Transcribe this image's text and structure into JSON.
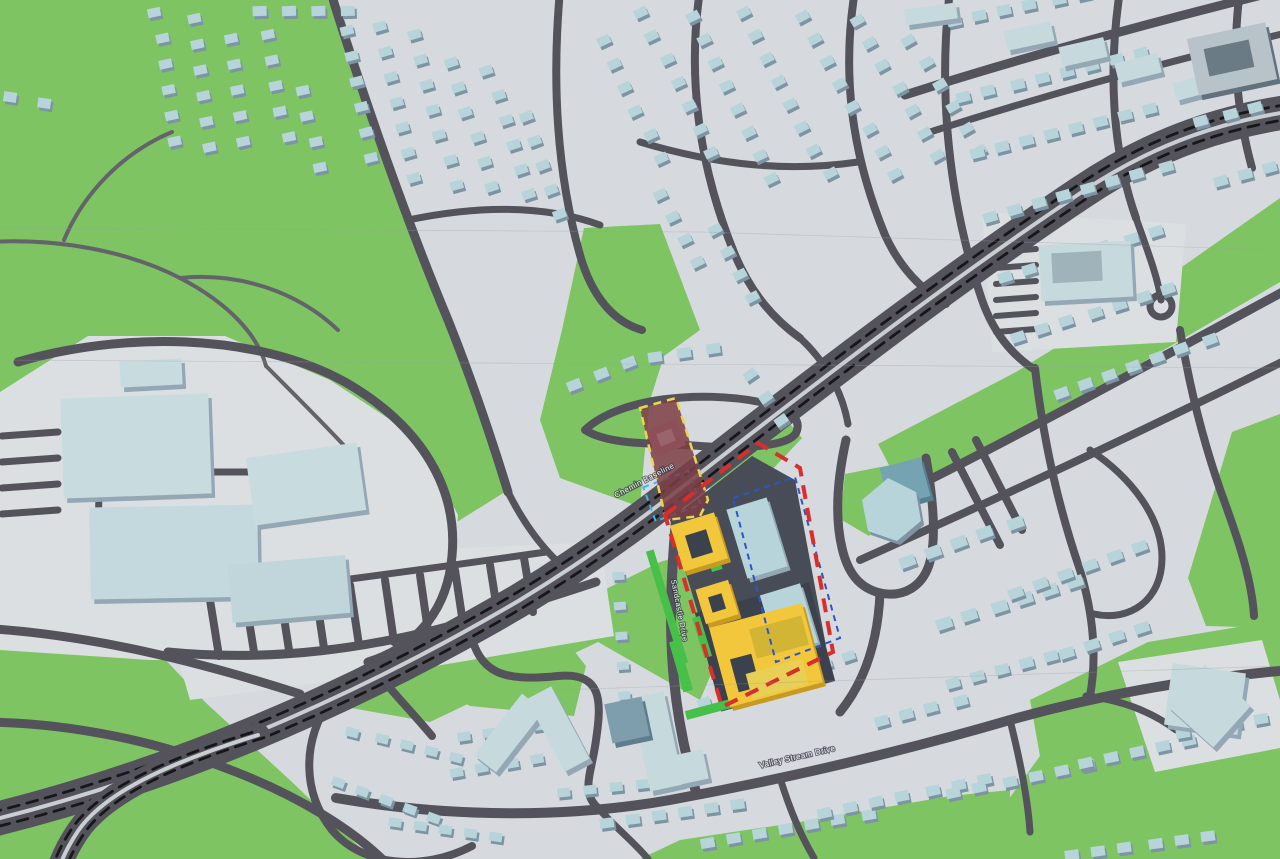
{
  "map": {
    "street_labels": [
      {
        "text": "Chemin Baseline"
      },
      {
        "text": "Sandcastle Drive"
      },
      {
        "text": "Valley Stream Drive"
      }
    ],
    "palette": {
      "pavement": "#d6dade",
      "pad": "#dbdfe2",
      "green": "#7ec462",
      "green_bright": "#46c049",
      "road": "#54535c",
      "trail": "#64636b",
      "median": "#c9ced3",
      "dash_black": "#17171a",
      "house": "#b6d4d9",
      "house_shadow": "#7d94a2",
      "big_building": "#c6d9dc",
      "big_side": "#93a8b4",
      "teal_tower": "#76a3b2",
      "site_asphalt": "#474c56",
      "site_podium": "#3c414e",
      "yellow_building": "#f3c73c",
      "yellow_side": "#c79a22",
      "yellow_roof_dark": "#3c414e",
      "yellow_roof_olive": "#d2b535",
      "yellow_roof_stripe": "#e8cf55",
      "maroon_overlay": "#7d3e45",
      "maroon_building": "#8d5059",
      "maroon_inner": "#9a646c",
      "boundary_red": "#d92e2c",
      "boundary_yellow": "#ead54e",
      "boundary_navy": "#2d55c8",
      "boundary_cyan": "#45b5e8",
      "seam": "#9aa0a6"
    },
    "greens": [
      "M0,0 L328,0 L400,185 L455,330 L505,492 L436,535 L300,482 L150,470 L0,464 Z",
      "M584,228 L660,224 L700,330 L664,356 L650,400 L644,460 L640,507 L560,478 L540,420 L562,330 Z",
      "M704,466 L790,424 L802,438 L770,472 L712,498 Z",
      "M845,474 L896,464 L906,500 L869,536 L840,519 Z",
      "M878,444 L1016,372 L1152,288 L1280,198 L1280,282 L1150,358 L1018,438 L904,494 Z",
      "M1030,700 L1148,642 L1280,620 L1280,859 L1005,859 L1008,800 L1040,756 Z",
      "M1232,432 L1280,414 L1280,628 L1206,626 L1188,578 Z",
      "M340,706 L520,632 L660,562 L712,546 L736,616 L700,700 L598,642 L430,722 Z",
      "M424,640 L556,628 L586,666 L574,716 L470,706 L428,682 Z",
      "M0,645 L162,656 L205,702 L292,782 L372,859 L0,859 Z",
      "M640,859 L680,840 L800,822 L950,796 L1010,790 L1010,859 Z"
    ],
    "pads": [
      "M0,392 L88,336 L225,336 L330,380 L418,438 L458,515 L452,585 L420,642 L330,660 L150,660 L0,650 Z",
      "M150,562 L600,542 L614,636 L400,672 L190,700 Z",
      "M982,212 L1186,224 L1176,342 L992,352 Z",
      "M1118,662 L1262,640 L1280,700 L1280,748 L1155,772 Z"
    ],
    "trails": [
      [
        "M-10,242 C60,238 130,252 180,278 C230,304 258,336 266,366",
        4
      ],
      [
        "M64,240 C84,192 124,152 172,132",
        4
      ],
      [
        "M180,278 C240,272 298,292 338,330",
        4
      ],
      [
        "M266,366 C300,400 330,430 350,452",
        4
      ]
    ],
    "roads": [
      [
        "M330,-10 C358,80 402,210 448,320 C470,375 492,440 508,492",
        9
      ],
      [
        "M560,-10 C552,80 556,170 580,255 C592,297 614,322 642,330",
        8
      ],
      [
        "M408,220 C480,205 545,205 600,225",
        7
      ],
      [
        "M700,-10 C688,70 696,160 735,255 C752,295 775,320 800,338",
        8
      ],
      [
        "M855,-10 C842,70 850,150 885,235 C900,268 922,290 946,304",
        8
      ],
      [
        "M640,142 C720,166 790,172 858,162",
        7
      ],
      [
        "M585,430 C618,398 700,390 760,402 C792,409 802,420 796,433 C788,447 740,449 700,446 C660,443 610,446 585,430",
        8
      ],
      [
        "M800,338 C824,360 842,390 848,424",
        7
      ],
      [
        "M905,95 C1030,55 1160,20 1290,-12",
        9
      ],
      [
        "M930,132 C1040,97 1150,66 1290,32",
        7
      ],
      [
        "M950,-10 C938,90 948,200 982,300 C994,334 1012,354 1032,368",
        8
      ],
      [
        "M1120,-10 C1108,70 1112,150 1136,218",
        8
      ],
      [
        "M1240,-10 C1232,50 1236,110 1252,168",
        8
      ],
      [
        "M1136,218 C1148,252 1158,278 1161,300",
        7
      ],
      [
        "M905,492 C1010,440 1120,380 1290,288",
        9
      ],
      [
        "M860,560 C980,506 1100,452 1290,358",
        8
      ],
      [
        "M1035,368 C1042,430 1056,500 1080,570 C1092,610 1098,652 1090,696",
        8
      ],
      [
        "M1180,330 C1190,390 1206,452 1226,506 C1240,545 1252,582 1254,616",
        8
      ],
      [
        "M1090,450 C1132,478 1162,518 1162,558 C1162,600 1130,622 1094,614",
        7
      ],
      [
        "M1086,696 C1122,700 1152,712 1176,730",
        7
      ],
      [
        "M678,498 C672,560 668,620 674,680 C678,722 686,758 696,792",
        10
      ],
      [
        "M470,632 C480,672 500,682 558,676 C602,672 602,700 596,740 C592,772 580,792 598,808",
        8
      ],
      [
        "M336,798 C450,818 570,818 670,800 C790,778 900,752 1010,720 C1110,692 1200,678 1290,670",
        10
      ],
      [
        "M596,806 C616,828 636,844 648,859",
        7
      ],
      [
        "M780,778 C790,810 800,834 814,858",
        7
      ],
      [
        "M1010,720 C1020,760 1028,800 1030,832",
        7
      ],
      [
        "M18,362 C120,332 255,332 345,382 C425,428 458,492 452,556 C448,606 420,646 368,662",
        9
      ],
      [
        "M95,408 C100,460 100,510 96,554",
        7
      ],
      [
        "M150,472 L265,472",
        7
      ],
      [
        "M168,652 C270,662 370,650 480,618 C530,604 566,592 596,582",
        9
      ],
      [
        "M200,598 C300,586 420,570 546,552",
        7
      ],
      [
        "M210,600 L219,656",
        8
      ],
      [
        "M245,596 L254,652",
        8
      ],
      [
        "M280,592 L289,650",
        8
      ],
      [
        "M315,588 L324,648",
        8
      ],
      [
        "M350,585 L359,645",
        8
      ],
      [
        "M385,580 L394,642",
        8
      ],
      [
        "M420,575 L429,638",
        8
      ],
      [
        "M455,570 L464,630",
        8
      ],
      [
        "M490,565 L499,622",
        8
      ],
      [
        "M524,558 L533,612",
        8
      ],
      [
        "M368,662 C392,692 412,712 432,736",
        8
      ],
      [
        "M330,700 C302,742 302,792 332,830 C362,866 422,872 472,846",
        8
      ],
      [
        "M-20,628 C90,634 200,662 300,694",
        9
      ],
      [
        "M-20,722 C70,722 160,742 236,772 C302,798 352,830 382,859",
        9
      ],
      [
        "M508,492 C522,520 540,546 562,566",
        7
      ],
      [
        "M996,252 L1036,249",
        6
      ],
      [
        "M996,268 L1036,265",
        6
      ],
      [
        "M996,284 L1036,281",
        6
      ],
      [
        "M996,300 L1036,297",
        6
      ],
      [
        "M996,316 L1036,313",
        6
      ],
      [
        "M996,332 L1036,329",
        6
      ],
      [
        "M2,436 L58,432",
        7
      ],
      [
        "M2,462 L58,458",
        7
      ],
      [
        "M2,488 L58,484",
        7
      ],
      [
        "M2,514 L58,510",
        7
      ],
      [
        "M846,440 C838,476 834,514 842,548 C848,574 860,588 880,593 C904,598 922,586 929,565 C937,540 933,498 926,458",
        9
      ],
      [
        "M952,452 L1000,545",
        8
      ],
      [
        "M976,440 L1022,530",
        8
      ],
      [
        "M880,593 C878,640 866,680 840,712",
        9
      ]
    ],
    "arterial": {
      "main": "M-24,824 C160,780 340,706 520,600 C612,544 668,498 748,436 C836,368 962,272 1082,192 C1158,141 1228,120 1300,110",
      "branch": "M258,735 C168,763 104,793 78,831 C66,849 58,866 56,882",
      "main_width": 34,
      "branch_width": 24,
      "main_offset": [
        4.4,
        6.7
      ],
      "branch_offset": [
        5.9,
        2.7
      ],
      "dash": "11 8"
    },
    "cul_de_sac": {
      "cx": 1161,
      "cy": 306,
      "r": 11
    },
    "house_rows": [
      [
        150,
        8,
        82,
        6,
        -12,
        26,
        13,
        9
      ],
      [
        186,
        14,
        82,
        6,
        -12,
        26,
        13,
        9
      ],
      [
        224,
        34,
        82,
        5,
        -12,
        26,
        13,
        9
      ],
      [
        262,
        30,
        80,
        5,
        -12,
        26,
        13,
        9
      ],
      [
        298,
        86,
        80,
        4,
        -12,
        26,
        13,
        9
      ],
      [
        338,
        26,
        78,
        6,
        -14,
        26,
        13,
        9
      ],
      [
        372,
        22,
        76,
        7,
        -16,
        26,
        13,
        9
      ],
      [
        408,
        30,
        75,
        7,
        -16,
        26,
        13,
        9
      ],
      [
        446,
        58,
        73,
        6,
        -18,
        26,
        13,
        9
      ],
      [
        482,
        66,
        72,
        6,
        -18,
        26,
        13,
        9
      ],
      [
        518,
        112,
        70,
        5,
        -20,
        26,
        13,
        9
      ],
      [
        252,
        6,
        0,
        4,
        -2,
        30,
        14,
        10
      ],
      [
        598,
        36,
        65,
        6,
        -25,
        26,
        13,
        9
      ],
      [
        636,
        8,
        64,
        7,
        -25,
        26,
        13,
        9
      ],
      [
        684,
        12,
        63,
        8,
        -26,
        26,
        13,
        9
      ],
      [
        736,
        8,
        62,
        8,
        -27,
        26,
        13,
        9
      ],
      [
        796,
        12,
        60,
        8,
        -28,
        26,
        13,
        9
      ],
      [
        852,
        16,
        60,
        7,
        -29,
        26,
        13,
        9
      ],
      [
        904,
        36,
        58,
        6,
        -30,
        26,
        13,
        9
      ],
      [
        652,
        190,
        60,
        4,
        -26,
        26,
        13,
        9
      ],
      [
        708,
        225,
        60,
        4,
        -27,
        26,
        13,
        9
      ],
      [
        948,
        16,
        -12,
        6,
        -12,
        26,
        14,
        10
      ],
      [
        958,
        92,
        -14,
        8,
        -14,
        26,
        14,
        10
      ],
      [
        968,
        148,
        -14,
        8,
        -14,
        26,
        14,
        10
      ],
      [
        982,
        212,
        -16,
        8,
        -16,
        26,
        14,
        10
      ],
      [
        998,
        272,
        -17,
        7,
        -17,
        26,
        14,
        10
      ],
      [
        1012,
        332,
        -18,
        7,
        -18,
        26,
        14,
        10
      ],
      [
        1196,
        116,
        -15,
        3,
        -15,
        26,
        14,
        10
      ],
      [
        1212,
        176,
        -15,
        3,
        -15,
        26,
        14,
        10
      ],
      [
        1054,
        388,
        -20,
        7,
        -20,
        26,
        14,
        10
      ],
      [
        900,
        556,
        -20,
        5,
        -20,
        28,
        16,
        11
      ],
      [
        938,
        618,
        -18,
        6,
        -18,
        27,
        16,
        11
      ],
      [
        1006,
        588,
        -20,
        6,
        -20,
        27,
        15,
        10
      ],
      [
        1058,
        648,
        -18,
        4,
        -18,
        27,
        15,
        10
      ],
      [
        946,
        678,
        -15,
        5,
        -15,
        26,
        14,
        10
      ],
      [
        876,
        716,
        -15,
        4,
        -15,
        26,
        14,
        10
      ],
      [
        700,
        698,
        -18,
        7,
        -18,
        25,
        13,
        9
      ],
      [
        598,
        818,
        -8,
        6,
        -8,
        27,
        14,
        10
      ],
      [
        700,
        838,
        -10,
        7,
        -10,
        27,
        14,
        10
      ],
      [
        818,
        808,
        -12,
        7,
        -12,
        27,
        14,
        10
      ],
      [
        948,
        788,
        -12,
        6,
        -12,
        27,
        14,
        10
      ],
      [
        1076,
        758,
        -12,
        5,
        -12,
        27,
        14,
        10
      ],
      [
        556,
        788,
        -6,
        4,
        -6,
        27,
        13,
        9
      ],
      [
        1176,
        728,
        -10,
        4,
        -10,
        27,
        14,
        10
      ],
      [
        1066,
        850,
        -8,
        6,
        -8,
        27,
        14,
        10
      ],
      [
        348,
        728,
        14,
        5,
        14,
        26,
        13,
        9
      ],
      [
        330,
        778,
        20,
        5,
        20,
        26,
        13,
        9
      ],
      [
        388,
        818,
        8,
        5,
        8,
        26,
        13,
        9
      ],
      [
        458,
        732,
        -8,
        4,
        -8,
        26,
        13,
        9
      ],
      [
        452,
        768,
        -10,
        4,
        -10,
        26,
        13,
        9
      ],
      [
        610,
        572,
        86,
        6,
        -4,
        30,
        12,
        8
      ],
      [
        566,
        380,
        -22,
        3,
        -22,
        30,
        14,
        10
      ],
      [
        648,
        352,
        -8,
        3,
        -8,
        30,
        14,
        10
      ],
      [
        745,
        370,
        55,
        3,
        -35,
        28,
        13,
        9
      ],
      [
        6,
        92,
        12,
        2,
        8,
        30,
        13,
        10
      ]
    ],
    "buildings": [
      [
        905,
        6,
        52,
        16,
        -8
      ],
      [
        1005,
        26,
        48,
        20,
        -12
      ],
      [
        1060,
        42,
        46,
        20,
        -13
      ],
      [
        1116,
        58,
        44,
        20,
        -14
      ],
      [
        1174,
        78,
        40,
        18,
        -15
      ],
      [
        1192,
        30,
        80,
        58,
        -12,
        "#b7c3c9",
        "#61727e",
        [
          14,
          14,
          46,
          28,
          "#6b7b86"
        ]
      ],
      [
        1040,
        243,
        92,
        56,
        -3,
        null,
        null,
        [
          12,
          9,
          50,
          30,
          "#9fb3ba"
        ]
      ],
      [
        884,
        462,
        42,
        40,
        -15,
        "#76a3b2",
        "#54808f"
      ],
      [
        495,
        694,
        28,
        78,
        38
      ],
      [
        544,
        688,
        28,
        82,
        -28
      ],
      [
        640,
        694,
        34,
        95,
        -12
      ],
      [
        608,
        700,
        38,
        40,
        -12,
        "#7e9dad",
        "#5f7d8c"
      ],
      [
        676,
        752,
        30,
        30,
        -12
      ],
      [
        62,
        396,
        148,
        100,
        -2,
        "#c8dcdf"
      ],
      [
        90,
        506,
        168,
        92,
        -1,
        "#c4d9dd"
      ],
      [
        250,
        450,
        112,
        68,
        -8,
        "#c8dcdf"
      ],
      [
        120,
        360,
        62,
        26,
        -3,
        "#c8dcdf"
      ],
      [
        230,
        560,
        118,
        58,
        -5,
        "#c0d6da"
      ],
      [
        1168,
        668,
        74,
        62,
        8
      ],
      [
        1178,
        678,
        62,
        56,
        42
      ]
    ],
    "hexagon_building": "M862,500 L888,478 L916,492 L921,521 L897,541 L868,531 Z",
    "site": {
      "asphalt": "M670,520 L752,456 L795,480 L826,646 L724,700 Z",
      "podium": [
        706,
        596,
        118,
        102,
        -15
      ],
      "greens": [
        [
          663,
          548,
          8,
          118,
          -17
        ],
        [
          684,
          696,
          116,
          9,
          -15
        ],
        [
          708,
          545,
          11,
          26,
          -17
        ],
        [
          718,
          582,
          9,
          22,
          -17
        ],
        [
          698,
          616,
          8,
          42,
          -17
        ],
        [
          676,
          640,
          10,
          52,
          -16
        ]
      ],
      "teal_buildings": [
        [
          736,
          502,
          42,
          72,
          -17
        ],
        [
          768,
          588,
          42,
          62,
          -17
        ]
      ],
      "yellow_buildings": [
        {
          "r": [
            676,
            518,
            46,
            48,
            -17
          ],
          "roof": [
            12,
            14,
            22,
            24,
            "dark"
          ]
        },
        {
          "r": [
            700,
            584,
            34,
            36,
            -17
          ],
          "roof": [
            10,
            11,
            14,
            16,
            "dark"
          ]
        },
        {
          "r": [
            718,
            614,
            96,
            82,
            -15
          ],
          "roof": [
            34,
            8,
            54,
            30,
            "olive"
          ],
          "roof2": [
            16,
            42,
            22,
            34,
            "dark"
          ],
          "inset": [
            30,
            52,
            58,
            26
          ]
        }
      ],
      "navy_dash": "M733,498 L795,477 L840,638 L776,662 Z",
      "cyan_dash": [
        648,
        478,
        48,
        36,
        -20
      ],
      "red_boundary": "M665,515 L758,443 L800,468 L833,652 L722,707 Z",
      "maroon": {
        "poly": "M640,408 L676,398 L708,500 L700,516 L666,520 Z",
        "building": [
          650,
          424,
          32,
          28,
          -22
        ],
        "inner": [
          658,
          431,
          16,
          13,
          -22
        ]
      }
    },
    "seams": [
      "M0,228 L700,232 L1280,250",
      "M0,360 L1280,368",
      "M556,690 L1280,666"
    ]
  }
}
